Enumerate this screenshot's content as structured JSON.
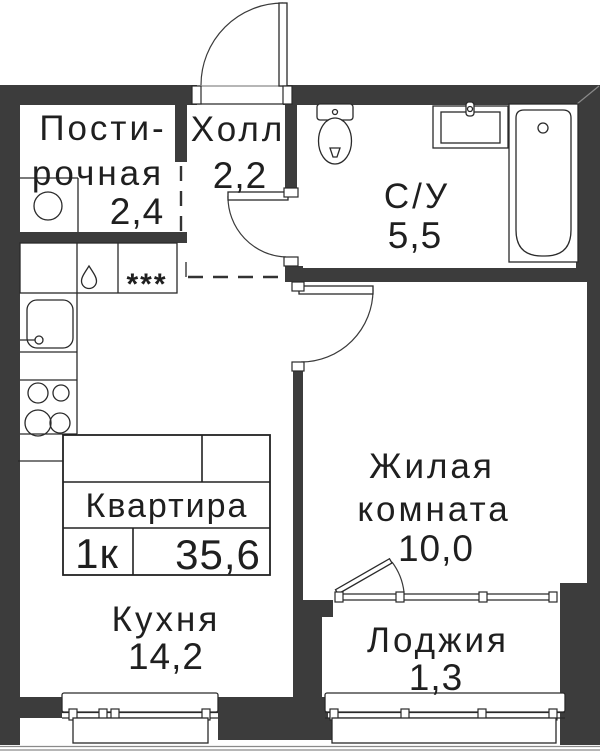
{
  "stamp": {
    "title": "Квартира",
    "rooms_label": "1к",
    "total_area": "35,6"
  },
  "rooms": {
    "laundry": {
      "name_line1": "Пости-",
      "name_line2": "рочная",
      "area": "2,4"
    },
    "hall": {
      "name": "Холл",
      "area": "2,2"
    },
    "bathroom": {
      "name": "С/У",
      "area": "5,5"
    },
    "living_room": {
      "name_line1": "Жилая",
      "name_line2": "комната",
      "area": "10,0"
    },
    "kitchen": {
      "name": "Кухня",
      "area": "14,2"
    },
    "loggia": {
      "name": "Лоджия",
      "area": "1,3"
    }
  },
  "symbols": {
    "freezer_stars": "***"
  },
  "icons": {
    "washing_machine": "circle-drum",
    "dishwasher": "water-droplet",
    "freezer": "three-stars",
    "kitchen_sink": "basin-with-faucet",
    "stove": "four-burners",
    "toilet": "tank-and-bowl",
    "bathroom_sink": "vanity-basin",
    "bathtub": "tub-with-drain"
  },
  "colors": {
    "wall": "#3c3c3c",
    "line": "#2a2a2a",
    "background": "#ffffff",
    "text": "#1f1f1f"
  }
}
